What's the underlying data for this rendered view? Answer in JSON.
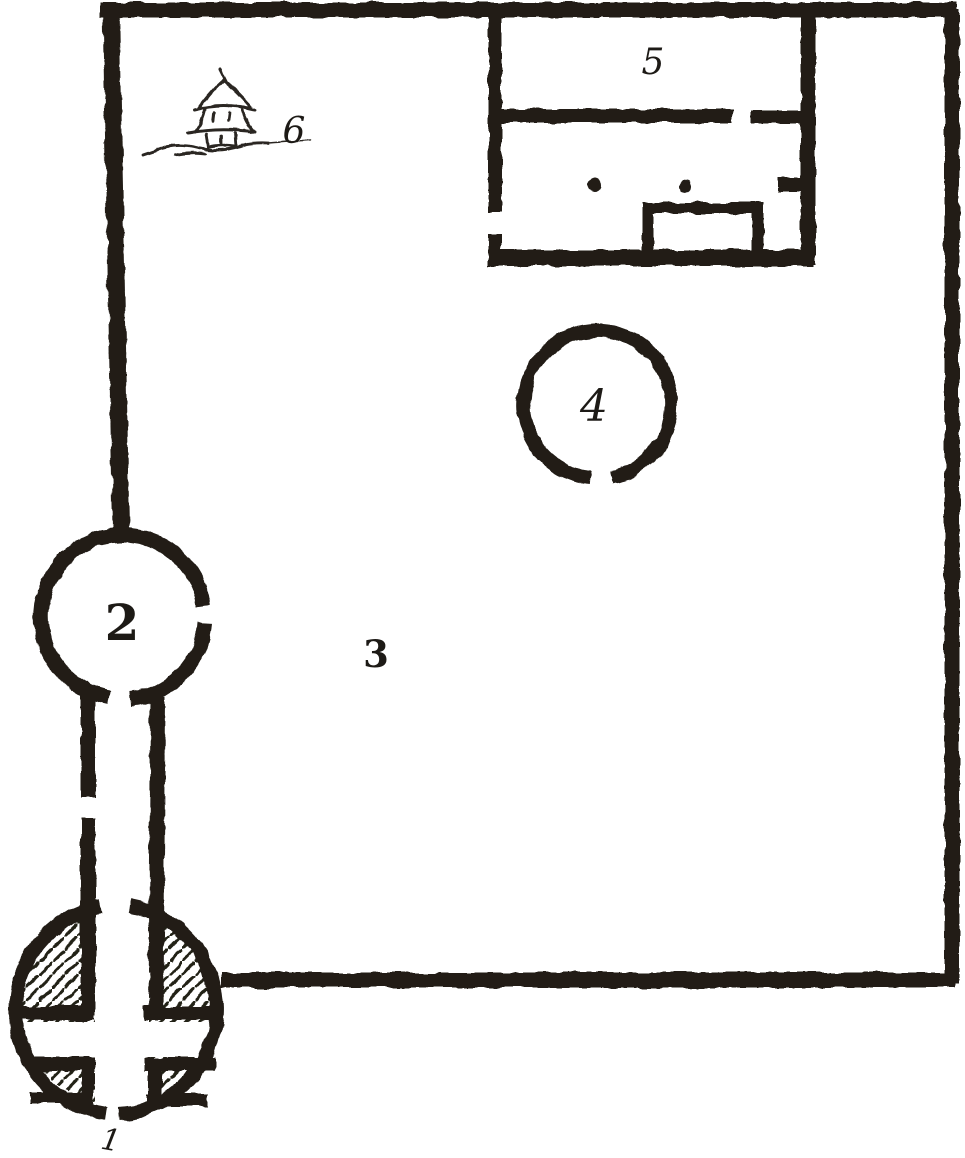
{
  "figure": {
    "paper_color": "#ffffff",
    "ink_color": "#221e19",
    "labels": [
      {
        "id": "1",
        "text": "1"
      },
      {
        "id": "2",
        "text": "2"
      },
      {
        "id": "3",
        "text": "3"
      },
      {
        "id": "4",
        "text": "4"
      },
      {
        "id": "5",
        "text": "5"
      },
      {
        "id": "6",
        "text": "6"
      }
    ],
    "icons": [
      {
        "name": "watchtower-sketch"
      },
      {
        "name": "post-dot"
      },
      {
        "name": "post-dot"
      }
    ]
  }
}
